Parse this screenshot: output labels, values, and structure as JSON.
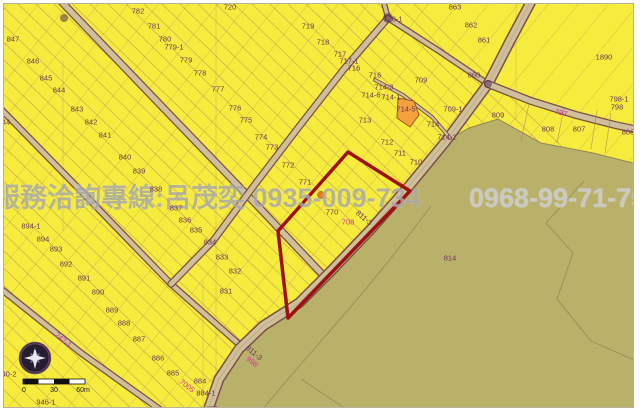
{
  "map": {
    "watermark": {
      "service_line": "服務洽詢專線:呂茂奕 0935-009-734",
      "phone_right": "0968-99-71-75"
    },
    "compass": {
      "north_label": "N"
    },
    "scale_bar": {
      "start": "0",
      "middle": "30",
      "end": "60m"
    },
    "selected_parcel": {
      "number": "770",
      "outline_color": "#a01010",
      "marker_color": "#e5791e"
    },
    "colors": {
      "parcel_yellow": "#f5ec3d",
      "forest_olive": "#b9b06a",
      "road_fill": "#cdc09a",
      "road_casing": "#7d4f45",
      "boundary_line": "#a26b6b",
      "label_text": "#6d3558",
      "special_label_magenta": "#d23399",
      "highlight_red": "#a01010",
      "highlight_orange_parcel": "#f2a13c"
    },
    "labels": [
      {
        "t": "847",
        "x": 12,
        "y": 38
      },
      {
        "t": "846",
        "x": 32,
        "y": 60
      },
      {
        "t": "845",
        "x": 45,
        "y": 77
      },
      {
        "t": "844",
        "x": 58,
        "y": 89
      },
      {
        "t": "843",
        "x": 76,
        "y": 108
      },
      {
        "t": "842",
        "x": 90,
        "y": 121
      },
      {
        "t": "841",
        "x": 104,
        "y": 134
      },
      {
        "t": "44",
        "x": 5,
        "y": 121
      },
      {
        "t": "782",
        "x": 137,
        "y": 10
      },
      {
        "t": "781",
        "x": 153,
        "y": 25
      },
      {
        "t": "780",
        "x": 164,
        "y": 38
      },
      {
        "t": "779-1",
        "x": 173,
        "y": 46
      },
      {
        "t": "779",
        "x": 185,
        "y": 59
      },
      {
        "t": "778",
        "x": 199,
        "y": 72
      },
      {
        "t": "777",
        "x": 217,
        "y": 88
      },
      {
        "t": "776",
        "x": 234,
        "y": 107
      },
      {
        "t": "775",
        "x": 245,
        "y": 119
      },
      {
        "t": "774",
        "x": 260,
        "y": 136
      },
      {
        "t": "773",
        "x": 271,
        "y": 146
      },
      {
        "t": "772",
        "x": 287,
        "y": 164
      },
      {
        "t": "771",
        "x": 304,
        "y": 181
      },
      {
        "t": "770",
        "x": 331,
        "y": 211
      },
      {
        "t": "720",
        "x": 229,
        "y": 6
      },
      {
        "t": "719",
        "x": 307,
        "y": 25
      },
      {
        "t": "718",
        "x": 322,
        "y": 41
      },
      {
        "t": "717",
        "x": 339,
        "y": 53
      },
      {
        "t": "717-1",
        "x": 348,
        "y": 60
      },
      {
        "t": "716",
        "x": 353,
        "y": 67
      },
      {
        "t": "716",
        "x": 374,
        "y": 74
      },
      {
        "t": "720-1",
        "x": 392,
        "y": 18
      },
      {
        "t": "714-3",
        "x": 383,
        "y": 86
      },
      {
        "t": "714-6",
        "x": 370,
        "y": 94
      },
      {
        "t": "714-1",
        "x": 390,
        "y": 96
      },
      {
        "t": "714-5",
        "x": 405,
        "y": 108
      },
      {
        "t": "713",
        "x": 364,
        "y": 119
      },
      {
        "t": "714",
        "x": 432,
        "y": 123
      },
      {
        "t": "714-2",
        "x": 446,
        "y": 136
      },
      {
        "t": "712",
        "x": 386,
        "y": 141
      },
      {
        "t": "711",
        "x": 399,
        "y": 152
      },
      {
        "t": "710",
        "x": 415,
        "y": 161
      },
      {
        "t": "709",
        "x": 420,
        "y": 79
      },
      {
        "t": "709-1",
        "x": 452,
        "y": 108
      },
      {
        "t": "860",
        "x": 473,
        "y": 74
      },
      {
        "t": "863",
        "x": 454,
        "y": 6
      },
      {
        "t": "862",
        "x": 470,
        "y": 24
      },
      {
        "t": "861",
        "x": 483,
        "y": 39
      },
      {
        "t": "1890",
        "x": 603,
        "y": 56
      },
      {
        "t": "809",
        "x": 497,
        "y": 114
      },
      {
        "t": "808",
        "x": 547,
        "y": 128
      },
      {
        "t": "807",
        "x": 578,
        "y": 128
      },
      {
        "t": "806",
        "x": 627,
        "y": 131
      },
      {
        "t": "798-1",
        "x": 618,
        "y": 98
      },
      {
        "t": "798",
        "x": 616,
        "y": 106
      },
      {
        "t": "797",
        "x": 560,
        "y": 112,
        "c": "m",
        "r": 14
      },
      {
        "t": "840",
        "x": 124,
        "y": 156
      },
      {
        "t": "839",
        "x": 138,
        "y": 170
      },
      {
        "t": "838",
        "x": 155,
        "y": 188
      },
      {
        "t": "837",
        "x": 175,
        "y": 207
      },
      {
        "t": "836",
        "x": 184,
        "y": 219
      },
      {
        "t": "835",
        "x": 195,
        "y": 229
      },
      {
        "t": "834",
        "x": 209,
        "y": 241
      },
      {
        "t": "833",
        "x": 221,
        "y": 256
      },
      {
        "t": "832",
        "x": 234,
        "y": 270
      },
      {
        "t": "831",
        "x": 225,
        "y": 290
      },
      {
        "t": "894-1",
        "x": 30,
        "y": 225
      },
      {
        "t": "894",
        "x": 42,
        "y": 238
      },
      {
        "t": "893",
        "x": 55,
        "y": 248
      },
      {
        "t": "892",
        "x": 65,
        "y": 263
      },
      {
        "t": "891",
        "x": 83,
        "y": 277
      },
      {
        "t": "890",
        "x": 97,
        "y": 291
      },
      {
        "t": "889",
        "x": 111,
        "y": 309
      },
      {
        "t": "888",
        "x": 123,
        "y": 322
      },
      {
        "t": "887",
        "x": 138,
        "y": 338
      },
      {
        "t": "886",
        "x": 157,
        "y": 357
      },
      {
        "t": "885",
        "x": 172,
        "y": 372
      },
      {
        "t": "884",
        "x": 199,
        "y": 380
      },
      {
        "t": "884-1",
        "x": 205,
        "y": 392
      },
      {
        "t": "7005",
        "x": 186,
        "y": 385,
        "c": "m",
        "r": 38
      },
      {
        "t": "814",
        "x": 449,
        "y": 257
      },
      {
        "t": "946-1",
        "x": 45,
        "y": 401
      },
      {
        "t": "40-2",
        "x": 8,
        "y": 373
      },
      {
        "t": "872",
        "x": 184,
        "y": 409
      },
      {
        "t": "875",
        "x": 211,
        "y": 408
      },
      {
        "t": "242-1",
        "x": 62,
        "y": 339,
        "c": "m",
        "r": 40
      },
      {
        "t": "811-3",
        "x": 363,
        "y": 217,
        "r": 40
      },
      {
        "t": "811-3",
        "x": 253,
        "y": 352,
        "r": 40
      },
      {
        "t": "998",
        "x": 251,
        "y": 361,
        "c": "m",
        "r": 38
      },
      {
        "t": "708",
        "x": 347,
        "y": 221,
        "c": "m"
      }
    ]
  }
}
